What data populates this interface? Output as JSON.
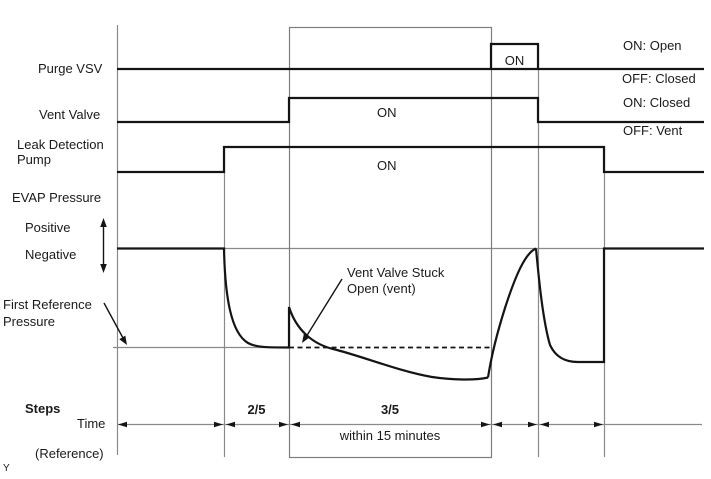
{
  "figure": {
    "corner_marker": "Y"
  },
  "rows": {
    "purge_vsv": {
      "label": "Purge VSV",
      "on_label": "ON",
      "legend_on": "ON: Open",
      "legend_off": "OFF: Closed"
    },
    "vent_valve": {
      "label": "Vent Valve",
      "on_label": "ON",
      "legend_on": "ON: Closed",
      "legend_off": "OFF: Vent"
    },
    "leak_detection_pump": {
      "label_line1": "Leak Detection",
      "label_line2": "Pump",
      "on_label": "ON"
    },
    "evap_pressure": {
      "label": "EVAP Pressure",
      "positive": "Positive",
      "negative": "Negative"
    }
  },
  "annotations": {
    "first_reference_line1": "First Reference",
    "first_reference_line2": "Pressure",
    "vent_stuck_line1": "Vent Valve Stuck",
    "vent_stuck_line2": "Open (vent)"
  },
  "timeline": {
    "steps_label": "Steps",
    "time_label": "Time",
    "reference_label": "(Reference)",
    "step_2_5": "2/5",
    "step_3_5": "3/5",
    "duration_note": "within 15 minutes"
  },
  "colors": {
    "signal_line": "#141414",
    "grid_line": "#8a8a8a",
    "background": "#ffffff",
    "text": "#1a1a1a"
  }
}
